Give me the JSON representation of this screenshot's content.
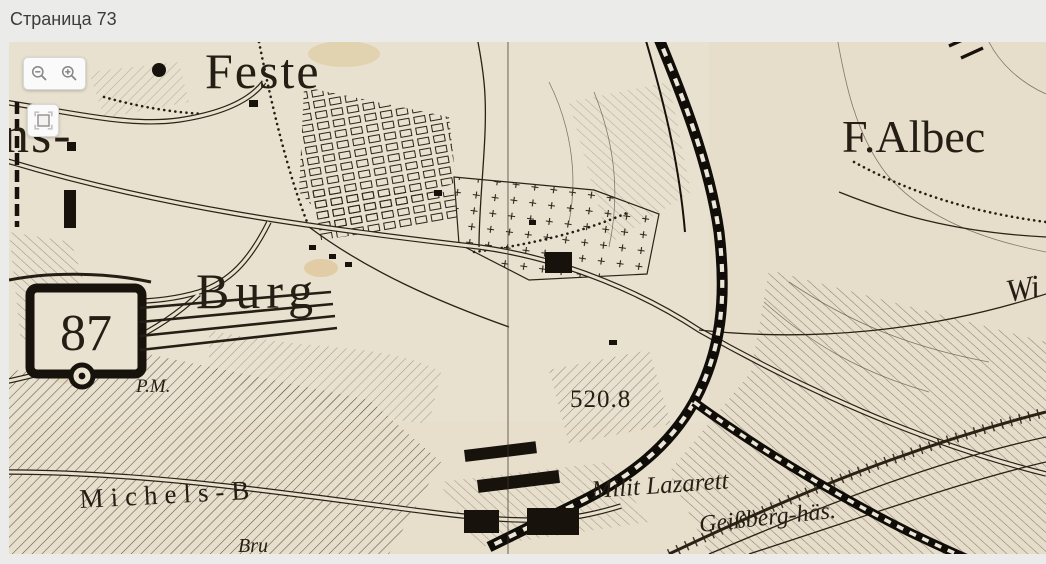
{
  "page": {
    "title": "Страница 73"
  },
  "viewer": {
    "controls": {
      "zoom_out_icon": "magnifier-minus",
      "zoom_in_icon": "magnifier-plus",
      "fullscreen_icon": "fit-square"
    },
    "map": {
      "paper_color": "#e8e1cf",
      "ink_color": "#221c13",
      "labels": {
        "feste": "Feste",
        "f_albeck": "F.Albec",
        "burg": "Burg",
        "fort_number": "87",
        "elevation": "520.8",
        "milit_lazarett": "Milit Lazarett",
        "geissberg": "Geißberg-häs.",
        "michelsberg": "Michels-B",
        "pm": "P.M.",
        "left_partial": "ns-",
        "right_partial": "Wi",
        "bottom_partial": "Bru"
      }
    }
  }
}
